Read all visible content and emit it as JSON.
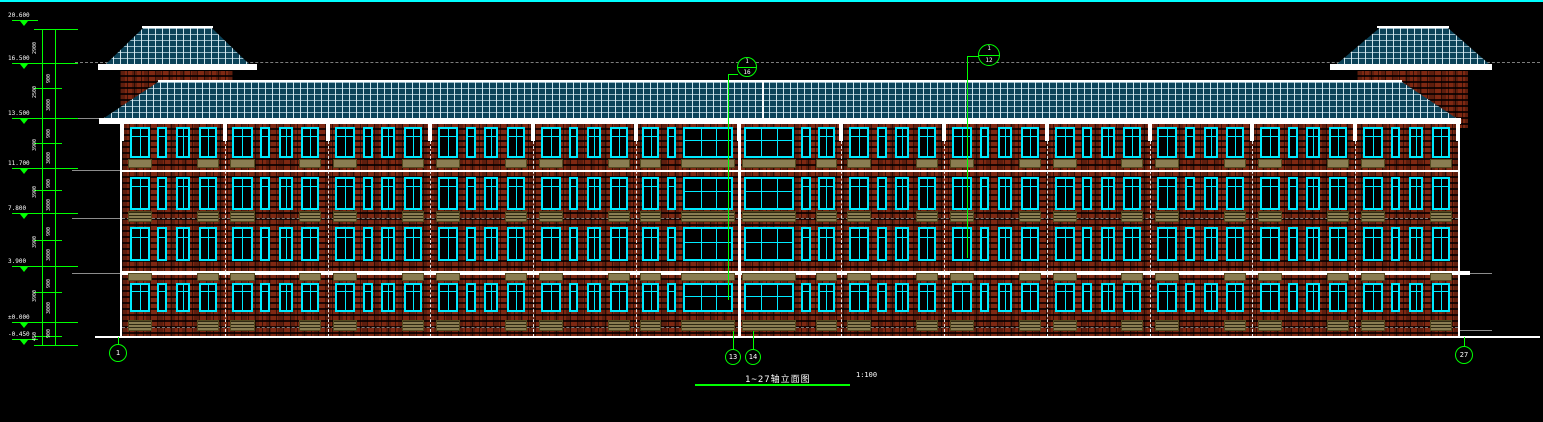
{
  "drawing": {
    "title": "1~27轴立面图",
    "scale": "1:100",
    "grid_bubbles": [
      {
        "id": "1",
        "x": 118,
        "y": 353,
        "r": 9,
        "stub": [
          337,
          345
        ]
      },
      {
        "id": "13",
        "x": 733,
        "y": 357,
        "r": 8,
        "stub": [
          331,
          350
        ]
      },
      {
        "id": "14",
        "x": 753,
        "y": 357,
        "r": 8,
        "stub": [
          331,
          350
        ]
      },
      {
        "id": "27",
        "x": 1464,
        "y": 355,
        "r": 9,
        "stub": [
          337,
          347
        ]
      }
    ],
    "detail_callouts": [
      {
        "top": "1",
        "bottom": "16",
        "cx": 747,
        "cy": 67,
        "r": 10,
        "leader": {
          "hx1": 728,
          "hx2": 738,
          "hy": 74,
          "vx": 728,
          "vy1": 74,
          "vy2": 300
        }
      },
      {
        "top": "1",
        "bottom": "12",
        "cx": 989,
        "cy": 55,
        "r": 11,
        "leader": {
          "hx1": 967,
          "hx2": 979,
          "hy": 56,
          "vx": 967,
          "vy1": 56,
          "vy2": 258
        }
      }
    ],
    "elevation_markers": [
      {
        "label": "20.600",
        "y": 20
      },
      {
        "label": "16.500",
        "y": 63
      },
      {
        "label": "13.500",
        "y": 118
      },
      {
        "label": "11.700",
        "y": 168
      },
      {
        "label": "7.800",
        "y": 213
      },
      {
        "label": "3.900",
        "y": 266
      },
      {
        "label": "±0.000",
        "y": 322
      },
      {
        "label": "-0.450",
        "y": 339
      }
    ],
    "dim_texts_outer": [
      {
        "y": 46,
        "t": "2900"
      },
      {
        "y": 90,
        "t": "2500"
      },
      {
        "y": 143,
        "t": "3900"
      },
      {
        "y": 190,
        "t": "3900"
      },
      {
        "y": 240,
        "t": "3900"
      },
      {
        "y": 294,
        "t": "3900"
      },
      {
        "y": 333,
        "t": "450"
      }
    ],
    "dim_texts_inner": [
      {
        "y": 75,
        "t": "900"
      },
      {
        "y": 103,
        "t": "3000"
      },
      {
        "y": 130,
        "t": "900"
      },
      {
        "y": 156,
        "t": "3000"
      },
      {
        "y": 180,
        "t": "900"
      },
      {
        "y": 203,
        "t": "3000"
      },
      {
        "y": 228,
        "t": "900"
      },
      {
        "y": 253,
        "t": "3000"
      },
      {
        "y": 280,
        "t": "900"
      },
      {
        "y": 306,
        "t": "3000"
      },
      {
        "y": 330,
        "t": "900"
      }
    ],
    "structure": {
      "floors": 4,
      "bays": 13,
      "axes_range": "1~27"
    },
    "colors": {
      "background": "#000000",
      "border_top": "#00ffff",
      "annotation_green": "#00ff00",
      "window_frame": "#00eaff",
      "roof_tile": "#0e4f68",
      "brick": "#7e2812",
      "sill_tan": "#8a7d52",
      "structure_line": "#ffffff",
      "reference_gray": "#8c8c8c"
    }
  }
}
